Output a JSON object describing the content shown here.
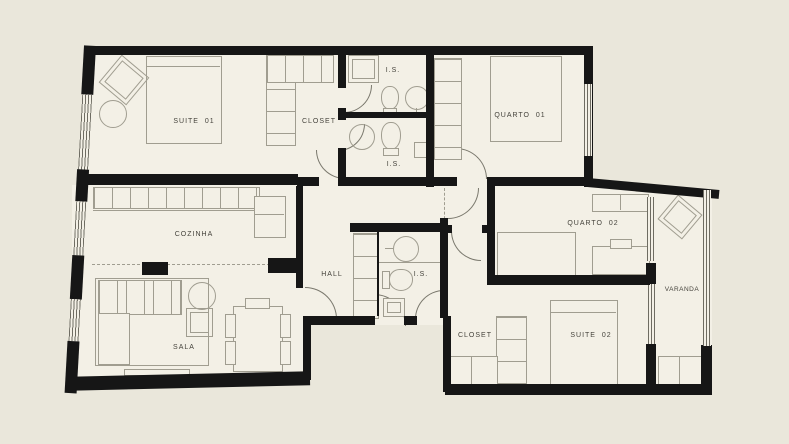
{
  "title": "apartment-floor-plan",
  "colors": {
    "canvas": "#eae7db",
    "floor": "#f3f0e6",
    "wall": "#161616",
    "line": "#a09d90",
    "winline": "#6e6c62",
    "door": "#7a786d",
    "text": "#45433c"
  },
  "rooms": [
    {
      "id": "suite-01",
      "label": "SUITE  01"
    },
    {
      "id": "closet-suite-01",
      "label": "CLOSET"
    },
    {
      "id": "is-upper",
      "label": "I.S."
    },
    {
      "id": "is-middle",
      "label": "I.S."
    },
    {
      "id": "quarto-01",
      "label": "QUARTO  01"
    },
    {
      "id": "cozinha",
      "label": "COZINHA"
    },
    {
      "id": "hall",
      "label": "HALL"
    },
    {
      "id": "is-hall",
      "label": "I.S."
    },
    {
      "id": "quarto-02",
      "label": "QUARTO  02"
    },
    {
      "id": "sala",
      "label": "SALA"
    },
    {
      "id": "closet-suite-02",
      "label": "CLOSET"
    },
    {
      "id": "suite-02",
      "label": "SUITE  02"
    },
    {
      "id": "varanda",
      "label": "VARANDA"
    }
  ],
  "fixtures": [
    "bed",
    "rug",
    "pouf",
    "wardrobe-shelves",
    "shower",
    "toilet",
    "washbasin",
    "kitchen-counter",
    "sofa",
    "coffee-table",
    "armchair",
    "dining-table",
    "chair",
    "tv-bench",
    "desk",
    "lounge-chair",
    "balcony-rail",
    "door",
    "window"
  ]
}
